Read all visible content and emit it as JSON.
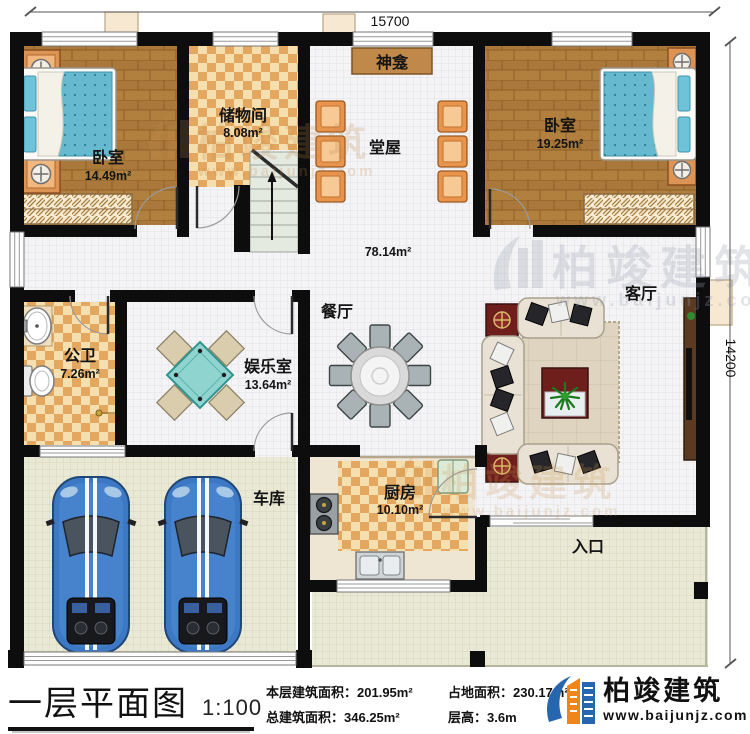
{
  "dimensions": {
    "top": "15700",
    "right": "14200"
  },
  "rooms": {
    "bedroom_left": {
      "name": "卧室",
      "area": "14.49m²"
    },
    "storage": {
      "name": "储物间",
      "area": "8.08m²"
    },
    "shrine": {
      "name": "神龛"
    },
    "hall": {
      "name": "堂屋"
    },
    "bedroom_right": {
      "name": "卧室",
      "area": "19.25m²"
    },
    "open_area": {
      "area": "78.14m²"
    },
    "dining": {
      "name": "餐厅"
    },
    "living": {
      "name": "客厅"
    },
    "bathroom": {
      "name": "公卫",
      "area": "7.26m²"
    },
    "game_room": {
      "name": "娱乐室",
      "area": "13.64m²"
    },
    "kitchen": {
      "name": "厨房",
      "area": "10.10m²"
    },
    "garage": {
      "name": "车库"
    },
    "entrance": {
      "name": "入口"
    }
  },
  "title_block": {
    "title": "一层平面图",
    "scale": "1:100",
    "stats": [
      {
        "label": "本层建筑面积：",
        "value": "201.95m²"
      },
      {
        "label": "占地面积：",
        "value": "230.17m²"
      },
      {
        "label": "总建筑面积：",
        "value": "346.25m²"
      },
      {
        "label": "层高：",
        "value": "3.6m"
      }
    ],
    "brand": {
      "name": "柏竣建筑",
      "site": "www.baijunjz.com"
    }
  },
  "watermark": {
    "name": "柏竣建筑",
    "site": "www.baijunjz.com"
  },
  "colors": {
    "wall": "#0d0d0d",
    "brand_blue": "#2566ae",
    "brand_orange": "#f08519"
  }
}
